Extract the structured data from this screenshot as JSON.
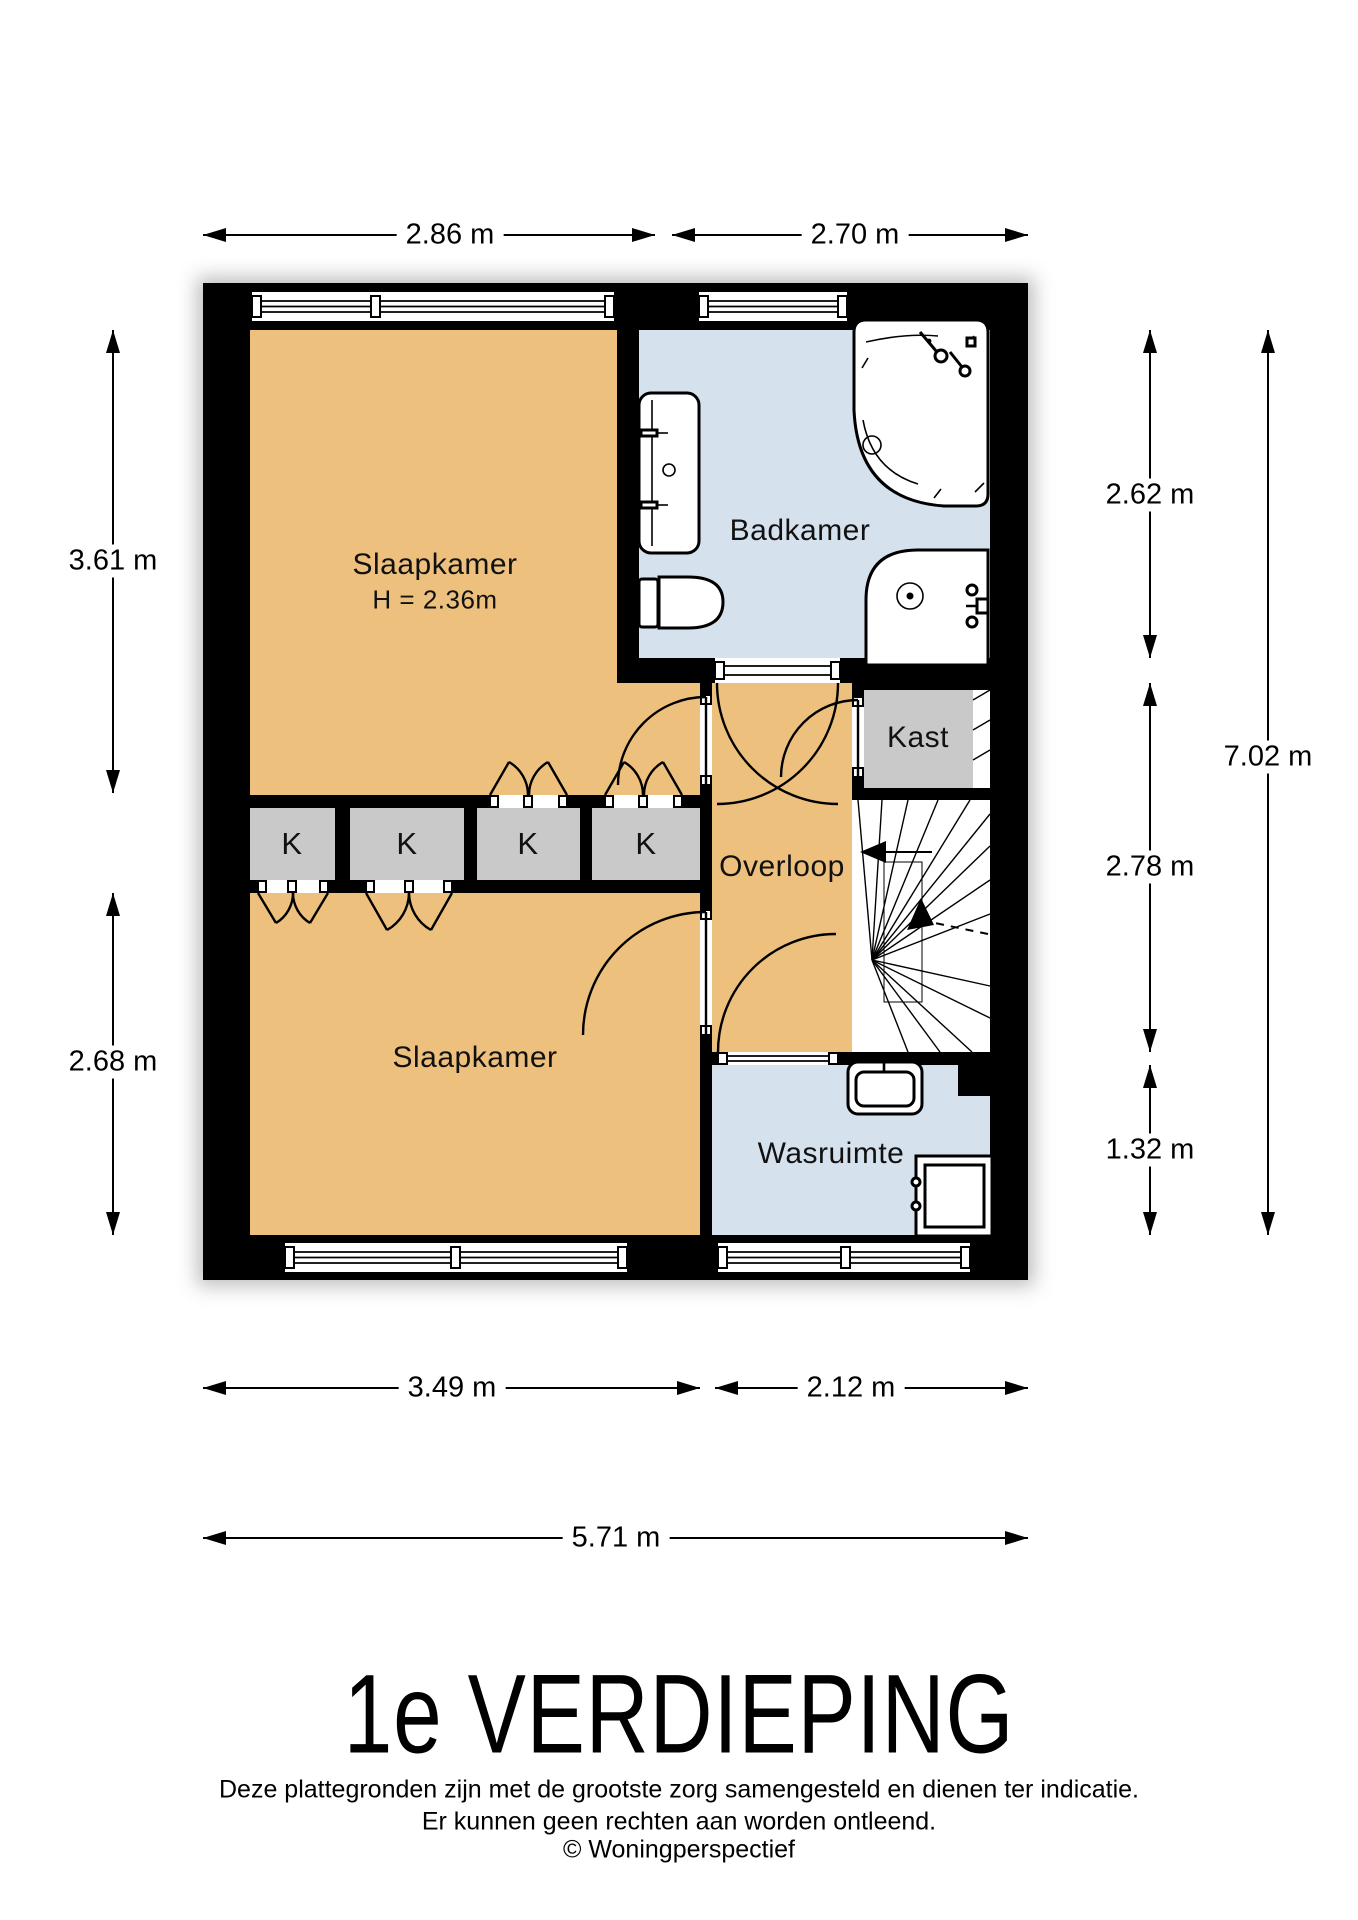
{
  "page": {
    "title": "1e VERDIEPING",
    "disclaimer1": "Deze plattegronden zijn met de grootste zorg samengesteld en dienen ter indicatie.",
    "disclaimer2": "Er kunnen geen rechten aan worden ontleend.",
    "credit": "© Woningperspectief"
  },
  "rooms": {
    "slaapkamer_top": {
      "label": "Slaapkamer",
      "height": "H = 2.36m"
    },
    "badkamer": {
      "label": "Badkamer"
    },
    "kast": {
      "label": "Kast"
    },
    "overloop": {
      "label": "Overloop"
    },
    "slaapkamer_bottom": {
      "label": "Slaapkamer"
    },
    "wasruimte": {
      "label": "Wasruimte"
    },
    "closet": {
      "label": "K"
    }
  },
  "dimensions": {
    "top": [
      {
        "label": "2.86 m"
      },
      {
        "label": "2.70 m"
      }
    ],
    "left": [
      {
        "label": "3.61 m"
      },
      {
        "label": "2.68 m"
      }
    ],
    "right": [
      {
        "label": "2.62 m"
      },
      {
        "label": "2.78 m"
      },
      {
        "label": "1.32 m"
      }
    ],
    "right_total": {
      "label": "7.02 m"
    },
    "bottom": [
      {
        "label": "3.49 m"
      },
      {
        "label": "2.12 m"
      }
    ],
    "bottom_total": {
      "label": "5.71 m"
    }
  },
  "colors": {
    "floor_orange": "#edc07d",
    "floor_blue": "#d6e1ee",
    "closet_gray": "#c9c9c9",
    "wall": "#000000"
  }
}
